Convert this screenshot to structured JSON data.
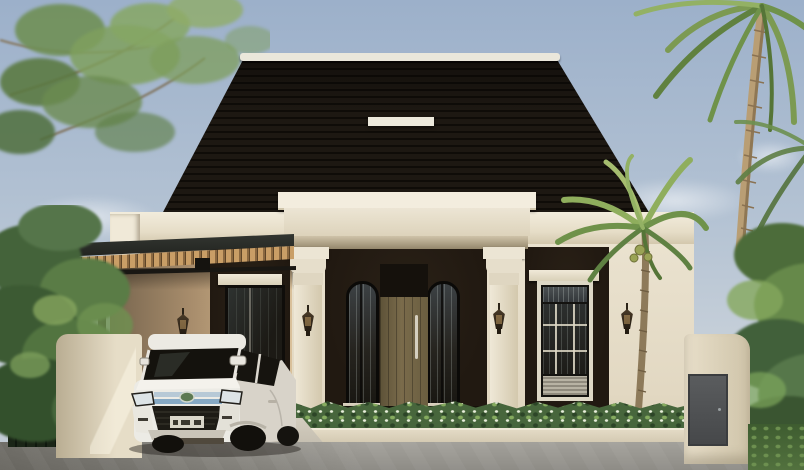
{
  "meta": {
    "type": "architectural-exterior-render",
    "description": "Front view of a modern-classic single-story house: steep dark-shingled hip roof with white ridge cap and skylight strip, cream stucco walls with a columned entry portico, dark recessed window bays, a flat carport canopy with wood-slat soffit sheltering a white MPV, flowering hedge, low cream boundary walls with a gray side gate, tropical palms and trees around, gray street in front."
  },
  "scene": {
    "sky": {
      "condition": "clear with faint clouds",
      "top_color": "#9cb0ca",
      "horizon_color": "#c7d0d9"
    },
    "roof": {
      "style": "hip roof, horizontal dark shingles",
      "color": "#1d1812",
      "ridge_cap_color": "#eae7db",
      "skylight": "white horizontal strip"
    },
    "facade": {
      "wall_color": "#e8e0cc",
      "cornice_color": "#f0ead9",
      "recess_panel_color": "#211911",
      "pilaster_count": 2,
      "wall_lamp_count": 4
    },
    "entrance": {
      "door": "olive-brown plank door with tall vertical pull handle",
      "door_color": "#6e6246",
      "arched_side_windows": 2,
      "transom": "dark"
    },
    "windows": {
      "left": "black-framed window behind carport with white head casing",
      "right": "black-framed grid window with white head casing, transom and louver panel"
    },
    "carport": {
      "canopy": "flat dark roof, timber slat soffit",
      "post_color": "#312f28",
      "downlight": true
    },
    "vehicle": {
      "type": "white 7-seat MPV",
      "body_color": "#eceae3",
      "grille": "double chrome bars with blue tint",
      "lower_grille": "black trapezoid mesh",
      "license_plate": "white plate, characters not legible"
    },
    "landscape": {
      "hedge": "low clipped hedge with tiny white flowers",
      "palm_front": "twin-crown palm before right wall",
      "palm_tall": "tall coconut palm upper right",
      "tree_left": "leafy shade tree upper left",
      "plants_left": "dense tropical shrubs and fan palm",
      "grass_right_color": "#52713e"
    },
    "hardscape": {
      "driveway_color": "#ccc6b8",
      "street_color": "#99978f",
      "curb_color": "#dcd3bd",
      "low_wall_color": "#e4dbc5",
      "side_gate_color": "#515355"
    }
  },
  "palette": {
    "sky_top": "#9cb0ca",
    "sky_low": "#c7d0d9",
    "roof": "#1d1812",
    "roof_stripe": "#0f0c08",
    "ridge": "#eae7db",
    "fascia": "#f0ead9",
    "wall": "#e8e0cc",
    "panel": "#211911",
    "pilaster": "#ece5d4",
    "door": "#6e6246",
    "handle": "#d5cfbf",
    "window_trim": "#ded8c6",
    "canopy": "#2b2e2a",
    "slat": "#c99e66",
    "post": "#312f28",
    "hedge": "#47663c",
    "hedge_light": "#85ab5f",
    "flower": "#e9efdc",
    "leaf": "#6f924a",
    "leaf_light": "#93b164",
    "leaf_dark": "#4c6c3a",
    "trunk": "#b99e74",
    "trunk_dark": "#8d7a5a",
    "curb": "#dcd3bd",
    "driveway": "#ccc6b8",
    "street": "#99978f",
    "lowwall": "#e4dbc5",
    "gate": "#515355",
    "grass": "#52713e",
    "car_body": "#eceae3",
    "car_glass": "#14120d",
    "chrome": "#b7c9d6",
    "chrome_blue": "#86a9c4",
    "bumper_dark": "#1d1b15"
  }
}
